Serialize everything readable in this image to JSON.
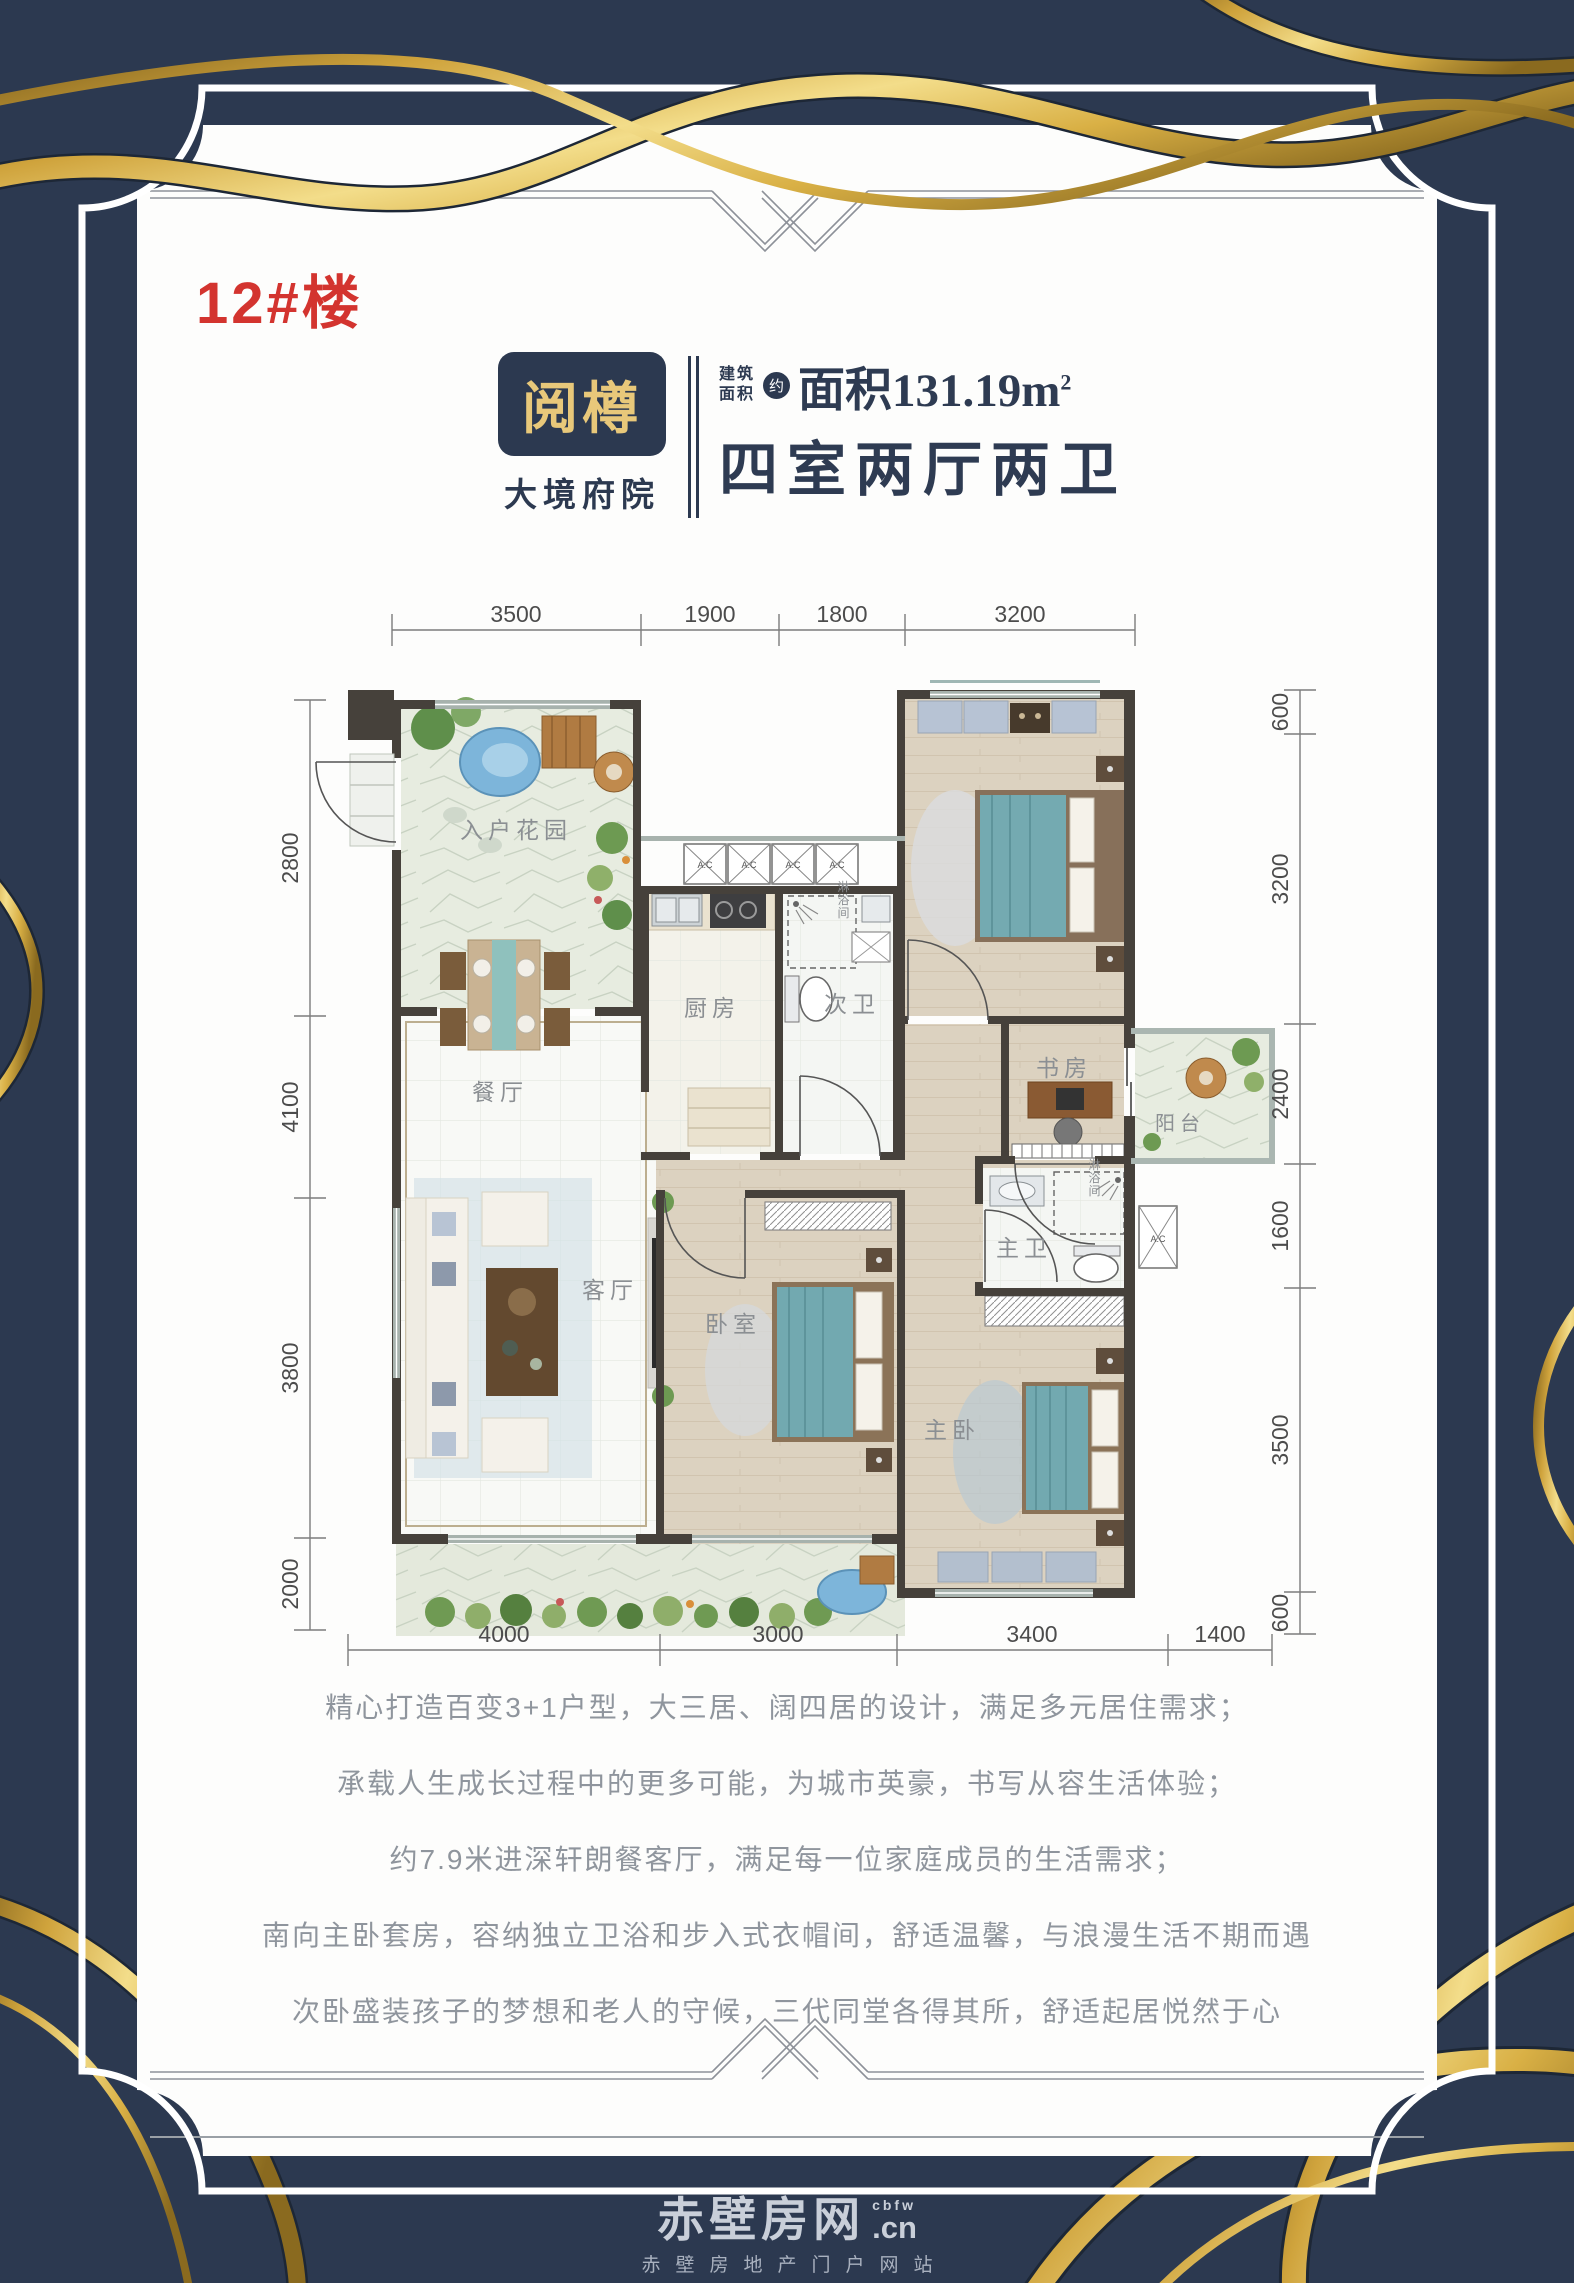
{
  "page": {
    "colors": {
      "background_navy": "#2c3950",
      "gold": "#d4af4e",
      "red": "#d3342f",
      "title_navy": "#2e3b52",
      "body_gray": "#8f959d"
    }
  },
  "building": {
    "label": "12#楼"
  },
  "brand": {
    "name": "阅樽",
    "sub": "大境府院"
  },
  "spec": {
    "area_label_1": "建筑",
    "area_label_2": "面积",
    "approx": "约",
    "area_value": "面积131.19m",
    "area_sup": "2",
    "layout": "四室两厅两卫"
  },
  "plan": {
    "rooms": {
      "entry_garden": "入户花园",
      "dining": "餐厅",
      "kitchen": "厨房",
      "second_bath": "次卫",
      "shower_a": "淋浴间",
      "living": "客厅",
      "bedroom": "卧室",
      "study": "书房",
      "balcony": "阳台",
      "master_bath": "主卫",
      "shower_b": "淋浴间",
      "master_bedroom": "主卧"
    },
    "ac_label": "A.C",
    "dims_top": [
      "3500",
      "1900",
      "1800",
      "3200"
    ],
    "dims_bottom": [
      "4000",
      "3000",
      "3400",
      "1400"
    ],
    "dims_left": [
      "2800",
      "4100",
      "3800",
      "2000"
    ],
    "dims_right": [
      "600",
      "3200",
      "2400",
      "1600",
      "3500",
      "600"
    ]
  },
  "description": {
    "lines": [
      "精心打造百变3+1户型，大三居、阔四居的设计，满足多元居住需求；",
      "承载人生成长过程中的更多可能，为城市英豪，书写从容生活体验；",
      "约7.9米进深轩朗餐客厅，满足每一位家庭成员的生活需求；",
      "南向主卧套房，容纳独立卫浴和步入式衣帽间，舒适温馨，与浪漫生活不期而遇",
      "次卧盛装孩子的梦想和老人的守候，三代同堂各得其所，舒适起居悦然于心"
    ]
  },
  "footer": {
    "logo_main": "赤壁房网",
    "logo_sup": "cbfw",
    "logo_cn": ".cn",
    "subtitle": "赤壁房地产门户网站"
  }
}
